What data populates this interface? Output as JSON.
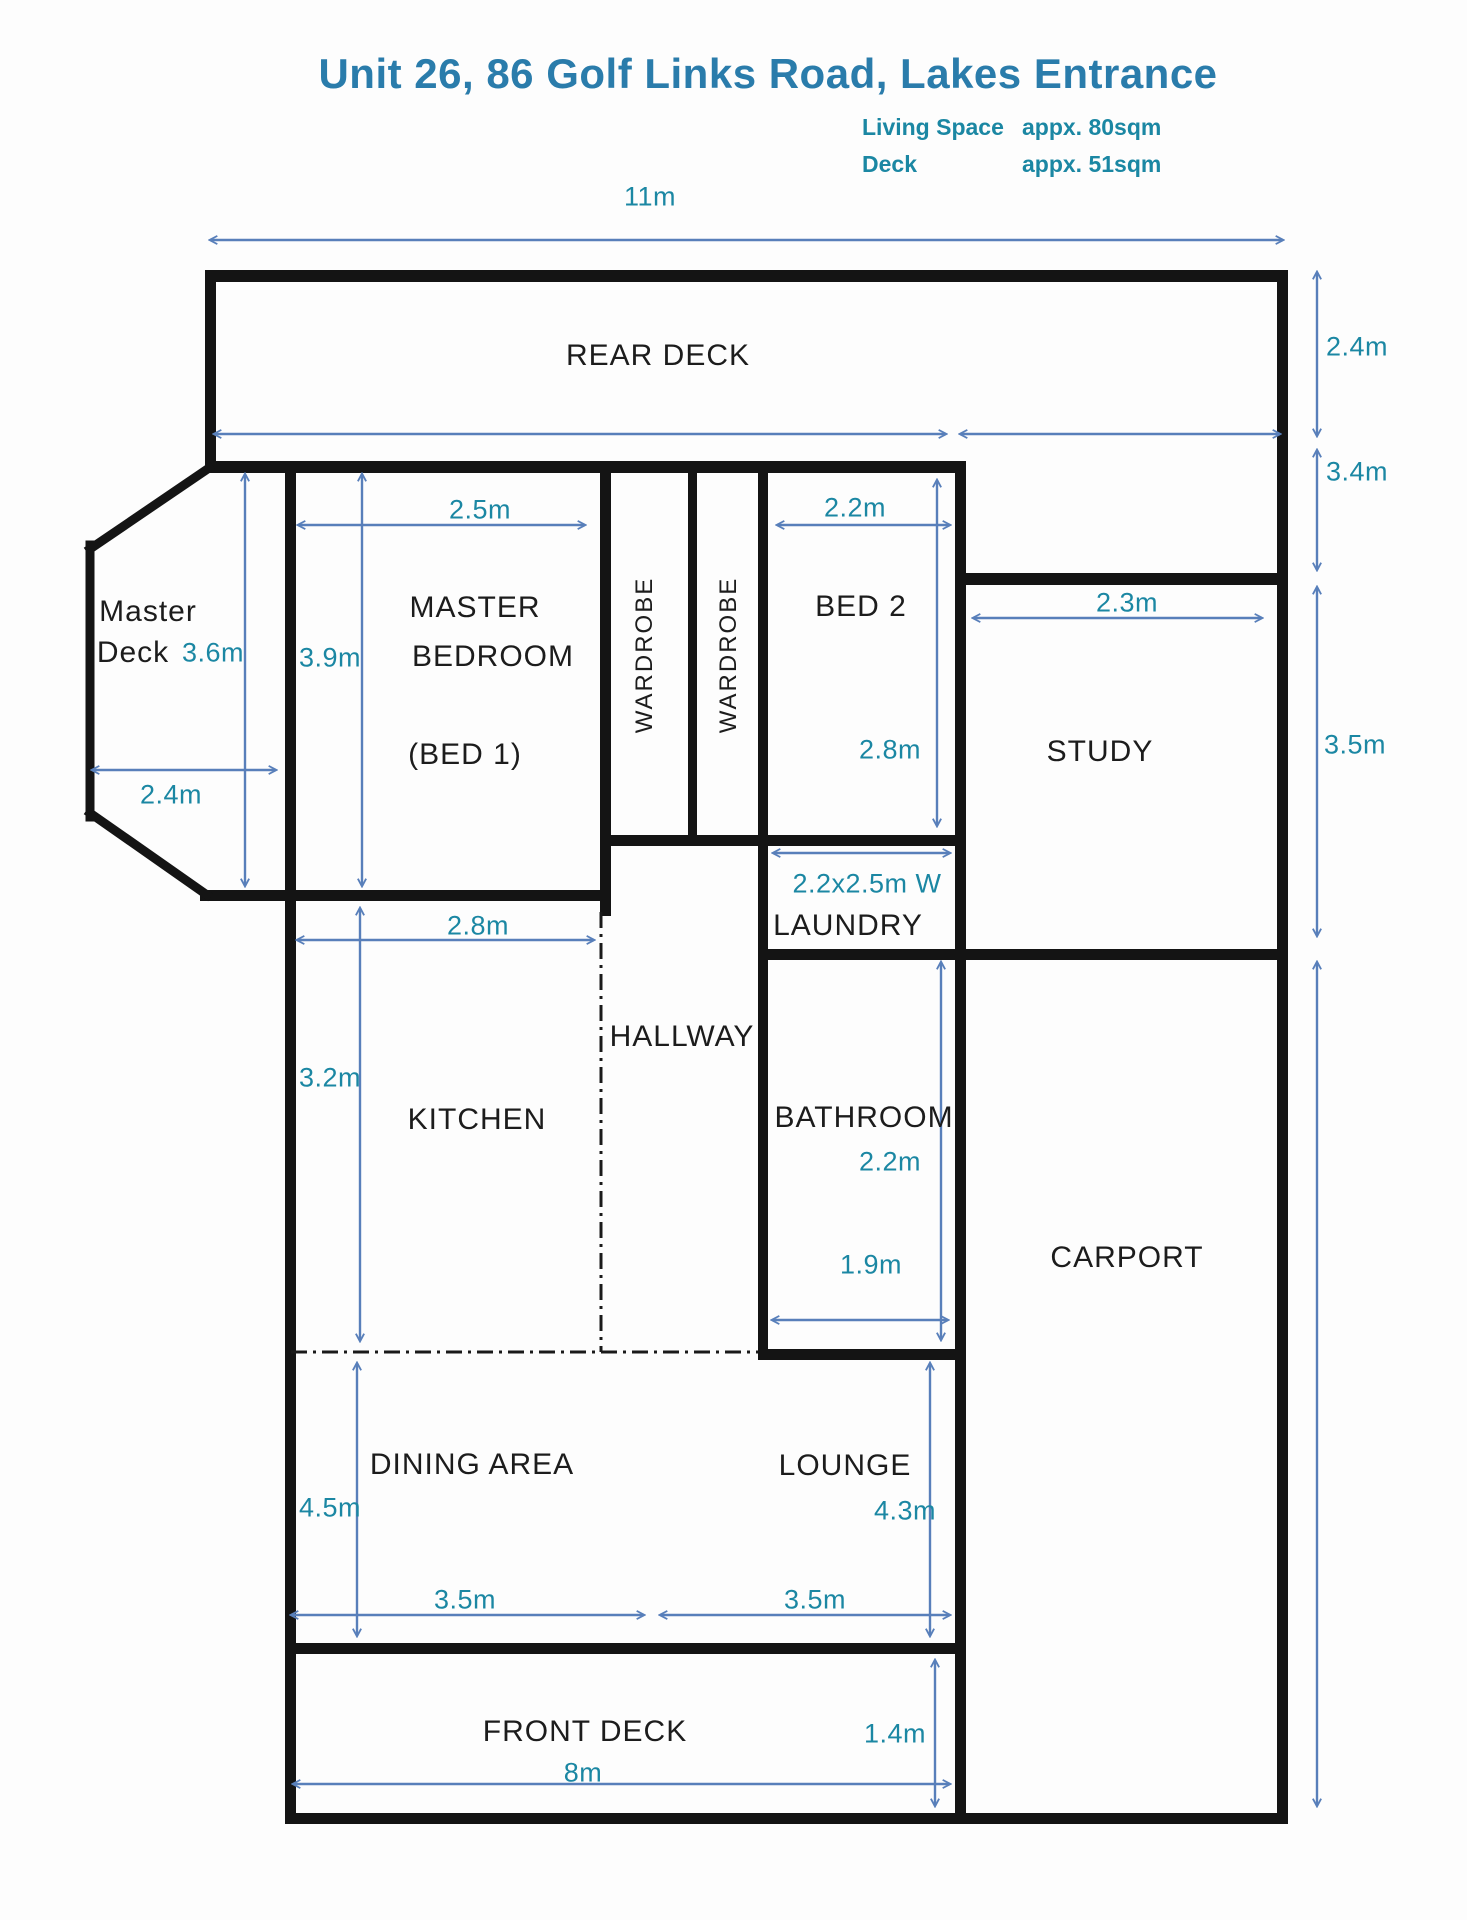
{
  "header": {
    "title": "Unit 26, 86 Golf Links Road, Lakes Entrance",
    "living_space_label": "Living Space",
    "living_space_value": "appx. 80sqm",
    "deck_label": "Deck",
    "deck_value": "appx. 51sqm"
  },
  "rooms": {
    "rear_deck": "REAR DECK",
    "master_deck_line1": "Master",
    "master_deck_line2": "Deck",
    "master_bedroom_line1": "MASTER",
    "master_bedroom_line2": "BEDROOM",
    "master_bedroom_line3": "(BED 1)",
    "wardrobe_1": "WARDROBE",
    "wardrobe_2": "WARDROBE",
    "bed2": "BED 2",
    "study": "STUDY",
    "laundry": "LAUNDRY",
    "hallway": "HALLWAY",
    "kitchen": "KITCHEN",
    "bathroom": "BATHROOM",
    "carport": "CARPORT",
    "dining": "DINING AREA",
    "lounge": "LOUNGE",
    "front_deck": "FRONT DECK"
  },
  "dims": {
    "overall_width": "11m",
    "rear_deck_depth": "2.4m",
    "right_upper": "3.4m",
    "right_study": "3.5m",
    "master_deck_height": "3.6m",
    "master_deck_width": "2.4m",
    "master_bedroom_width": "2.5m",
    "master_bedroom_height": "3.9m",
    "bed2_width": "2.2m",
    "bed2_height": "2.8m",
    "study_width": "2.3m",
    "laundry_size": "2.2x2.5m W",
    "kitchen_width": "2.8m",
    "kitchen_height": "3.2m",
    "bathroom_height": "2.2m",
    "bathroom_width": "1.9m",
    "dining_height": "4.5m",
    "lounge_height": "4.3m",
    "dining_width": "3.5m",
    "lounge_width": "3.5m",
    "front_deck_width": "8m",
    "front_deck_depth": "1.4m"
  },
  "colors": {
    "title": "#2a7cab",
    "dimension": "#1b87a3",
    "arrow": "#587fba",
    "wall": "#141414"
  }
}
